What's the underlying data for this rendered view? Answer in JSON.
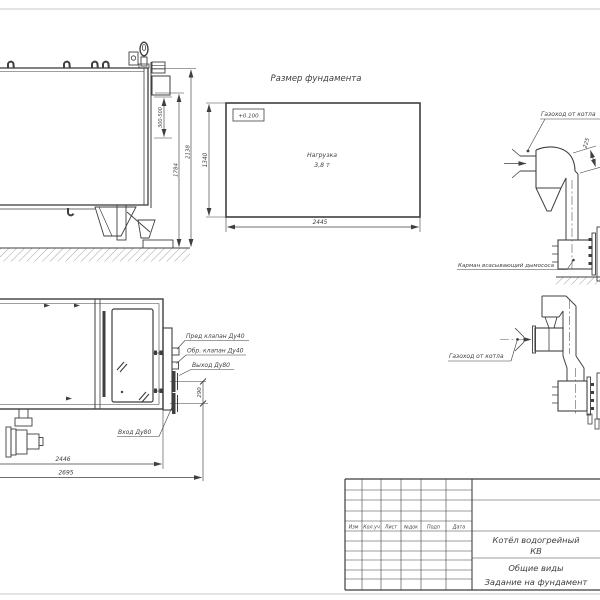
{
  "drawing": {
    "colors": {
      "line": "#3f3f3f",
      "frame": "#c9c9c9",
      "background": "#ffffff"
    },
    "foundation_view": {
      "title": "Размер фундамента",
      "level_mark": "+0.100",
      "load_label": "Нагрузка",
      "load_value": "3,8 т",
      "dim_width": "2445",
      "dim_height": "1340"
    },
    "side_view": {
      "dim_flue_gap": "300-500",
      "dim_body_height": "1784",
      "dim_total_height": "2138"
    },
    "plan_view": {
      "label_safety_valve": "Пред клапан Ду40",
      "label_check_valve": "Обр. клапан Ду40",
      "label_outlet": "Выход Ду80",
      "label_inlet": "Вход Ду80",
      "dim_nozzle_spacing": "290",
      "dim_body_length": "2446",
      "dim_total_length": "2695"
    },
    "flue_upper_view": {
      "label_flue": "Газоход от котла",
      "dim_offset": "225",
      "label_pocket": "Карман всасывающий дымососа"
    },
    "flue_lower_view": {
      "label_flue": "Газоход от котла"
    },
    "title_block": {
      "col_izm": "Изм",
      "col_koluch": "Кол.уч",
      "col_list": "Лист",
      "col_ndok": "№док",
      "col_podp": "Подп",
      "col_data": "Дата",
      "product_line1": "Котёл водогрейный",
      "product_line2": "КВ",
      "doc_line1": "Общие виды",
      "doc_line2": "Задание на фундамент"
    }
  }
}
